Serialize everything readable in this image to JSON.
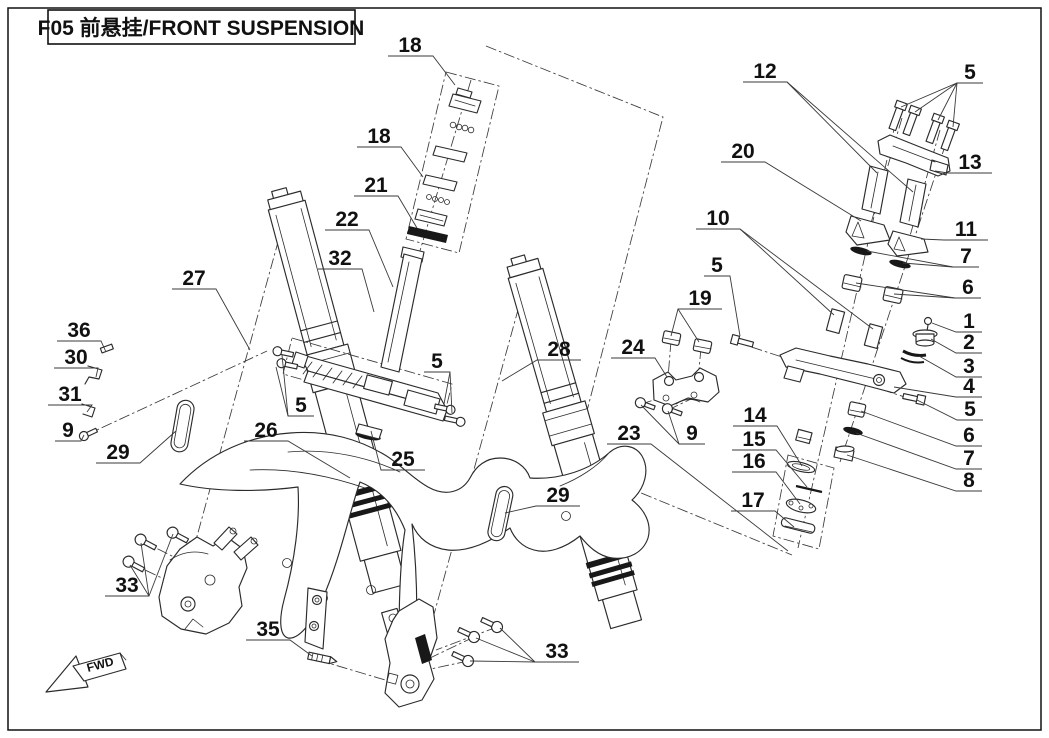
{
  "title": {
    "text": "F05 前悬挂/FRONT SUSPENSION"
  },
  "fwd_marker": "FWD",
  "diagram": {
    "type": "exploded-parts-diagram",
    "subject": "front suspension assembly",
    "part_numbers_shown": [
      "1",
      "2",
      "3",
      "4",
      "5",
      "6",
      "7",
      "8",
      "9",
      "10",
      "11",
      "12",
      "13",
      "14",
      "15",
      "16",
      "17",
      "18",
      "19",
      "20",
      "21",
      "22",
      "23",
      "24",
      "25",
      "26",
      "27",
      "28",
      "29",
      "30",
      "31",
      "32",
      "33",
      "35",
      "36"
    ]
  },
  "callouts": [
    {
      "n": "18",
      "t": [
        410,
        44
      ],
      "l": [
        [
          [
            388,
            56
          ],
          [
            433,
            56
          ],
          [
            455,
            85
          ]
        ]
      ]
    },
    {
      "n": "18",
      "t": [
        379,
        135
      ],
      "l": [
        [
          [
            357,
            147
          ],
          [
            401,
            147
          ],
          [
            423,
            177
          ]
        ]
      ]
    },
    {
      "n": "21",
      "t": [
        376,
        184
      ],
      "l": [
        [
          [
            354,
            196
          ],
          [
            398,
            196
          ],
          [
            417,
            228
          ]
        ]
      ]
    },
    {
      "n": "22",
      "t": [
        347,
        218
      ],
      "l": [
        [
          [
            325,
            230
          ],
          [
            369,
            230
          ],
          [
            393,
            287
          ]
        ]
      ]
    },
    {
      "n": "32",
      "t": [
        340,
        257
      ],
      "l": [
        [
          [
            318,
            269
          ],
          [
            362,
            269
          ],
          [
            374,
            312
          ]
        ]
      ]
    },
    {
      "n": "27",
      "t": [
        194,
        277
      ],
      "l": [
        [
          [
            172,
            289
          ],
          [
            216,
            289
          ],
          [
            250,
            350
          ]
        ]
      ]
    },
    {
      "n": "36",
      "t": [
        79,
        329
      ],
      "l": [
        [
          [
            57,
            341
          ],
          [
            101,
            341
          ],
          [
            106,
            352
          ]
        ]
      ]
    },
    {
      "n": "30",
      "t": [
        76,
        356
      ],
      "l": [
        [
          [
            54,
            368
          ],
          [
            98,
            368
          ],
          [
            96,
            377
          ]
        ]
      ]
    },
    {
      "n": "31",
      "t": [
        70,
        393
      ],
      "l": [
        [
          [
            48,
            405
          ],
          [
            92,
            405
          ],
          [
            87,
            412
          ]
        ]
      ]
    },
    {
      "n": "9",
      "t": [
        68,
        429
      ],
      "l": [
        [
          [
            55,
            441
          ],
          [
            81,
            441
          ],
          [
            84,
            435
          ]
        ]
      ]
    },
    {
      "n": "29",
      "t": [
        118,
        451
      ],
      "l": [
        [
          [
            96,
            463
          ],
          [
            140,
            463
          ],
          [
            176,
            431
          ]
        ]
      ]
    },
    {
      "n": "26",
      "t": [
        266,
        429
      ],
      "l": [
        [
          [
            244,
            441
          ],
          [
            288,
            441
          ],
          [
            350,
            478
          ]
        ]
      ]
    },
    {
      "n": "5",
      "t": [
        301,
        404
      ],
      "l": [
        [
          [
            314,
            416
          ],
          [
            288,
            416
          ],
          [
            276,
            367
          ]
        ],
        [
          [
            288,
            416
          ],
          [
            282,
            355
          ]
        ]
      ]
    },
    {
      "n": "25",
      "t": [
        403,
        458
      ],
      "l": [
        [
          [
            425,
            470
          ],
          [
            381,
            470
          ],
          [
            371,
            431
          ]
        ]
      ]
    },
    {
      "n": "28",
      "t": [
        559,
        348
      ],
      "l": [
        [
          [
            581,
            360
          ],
          [
            537,
            360
          ],
          [
            502,
            381
          ]
        ]
      ]
    },
    {
      "n": "29",
      "t": [
        558,
        494
      ],
      "l": [
        [
          [
            580,
            506
          ],
          [
            536,
            506
          ],
          [
            505,
            513
          ]
        ]
      ]
    },
    {
      "n": "33",
      "t": [
        127,
        584
      ],
      "l": [
        [
          [
            105,
            596
          ],
          [
            149,
            596
          ],
          [
            141,
            543
          ]
        ],
        [
          [
            149,
            596
          ],
          [
            173,
            534
          ]
        ],
        [
          [
            149,
            596
          ],
          [
            130,
            565
          ]
        ]
      ]
    },
    {
      "n": "35",
      "t": [
        268,
        628
      ],
      "l": [
        [
          [
            246,
            640
          ],
          [
            290,
            640
          ],
          [
            312,
            656
          ]
        ]
      ]
    },
    {
      "n": "33",
      "t": [
        557,
        650
      ],
      "l": [
        [
          [
            579,
            662
          ],
          [
            535,
            662
          ],
          [
            500,
            628
          ]
        ],
        [
          [
            535,
            662
          ],
          [
            476,
            638
          ]
        ],
        [
          [
            535,
            662
          ],
          [
            470,
            661
          ]
        ]
      ]
    },
    {
      "n": "12",
      "t": [
        765,
        70
      ],
      "l": [
        [
          [
            743,
            82
          ],
          [
            787,
            82
          ],
          [
            877,
            173
          ]
        ],
        [
          [
            787,
            82
          ],
          [
            913,
            192
          ]
        ]
      ]
    },
    {
      "n": "5",
      "t": [
        970,
        71
      ],
      "l": [
        [
          [
            983,
            83
          ],
          [
            957,
            83
          ],
          [
            901,
            107
          ]
        ],
        [
          [
            957,
            83
          ],
          [
            915,
            112
          ]
        ],
        [
          [
            957,
            83
          ],
          [
            938,
            120
          ]
        ],
        [
          [
            957,
            83
          ],
          [
            953,
            127
          ]
        ]
      ]
    },
    {
      "n": "20",
      "t": [
        743,
        150
      ],
      "l": [
        [
          [
            721,
            162
          ],
          [
            765,
            162
          ],
          [
            861,
            221
          ]
        ]
      ]
    },
    {
      "n": "13",
      "t": [
        970,
        161
      ],
      "l": [
        [
          [
            992,
            173
          ],
          [
            948,
            173
          ],
          [
            935,
            171
          ]
        ]
      ]
    },
    {
      "n": "10",
      "t": [
        718,
        217
      ],
      "l": [
        [
          [
            696,
            229
          ],
          [
            740,
            229
          ],
          [
            834,
            315
          ]
        ],
        [
          [
            740,
            229
          ],
          [
            873,
            329
          ]
        ]
      ]
    },
    {
      "n": "11",
      "t": [
        966,
        228
      ],
      "l": [
        [
          [
            988,
            240
          ],
          [
            944,
            240
          ],
          [
            921,
            239
          ]
        ]
      ]
    },
    {
      "n": "7",
      "t": [
        966,
        255
      ],
      "l": [
        [
          [
            979,
            267
          ],
          [
            953,
            267
          ],
          [
            867,
            251
          ]
        ],
        [
          [
            953,
            267
          ],
          [
            903,
            263
          ]
        ]
      ]
    },
    {
      "n": "6",
      "t": [
        968,
        286
      ],
      "l": [
        [
          [
            981,
            298
          ],
          [
            955,
            298
          ],
          [
            856,
            283
          ]
        ],
        [
          [
            955,
            298
          ],
          [
            894,
            294
          ]
        ]
      ]
    },
    {
      "n": "5",
      "t": [
        717,
        264
      ],
      "l": [
        [
          [
            704,
            276
          ],
          [
            730,
            276
          ],
          [
            740,
            336
          ]
        ]
      ]
    },
    {
      "n": "19",
      "t": [
        700,
        297
      ],
      "l": [
        [
          [
            722,
            309
          ],
          [
            678,
            309
          ],
          [
            671,
            336
          ]
        ],
        [
          [
            678,
            309
          ],
          [
            699,
            342
          ]
        ]
      ]
    },
    {
      "n": "1",
      "t": [
        969,
        320
      ],
      "l": [
        [
          [
            982,
            332
          ],
          [
            956,
            332
          ],
          [
            932,
            323
          ]
        ]
      ]
    },
    {
      "n": "2",
      "t": [
        969,
        341
      ],
      "l": [
        [
          [
            982,
            353
          ],
          [
            956,
            353
          ],
          [
            931,
            339
          ]
        ]
      ]
    },
    {
      "n": "3",
      "t": [
        969,
        365
      ],
      "l": [
        [
          [
            982,
            377
          ],
          [
            956,
            377
          ],
          [
            919,
            356
          ]
        ]
      ]
    },
    {
      "n": "4",
      "t": [
        969,
        385
      ],
      "l": [
        [
          [
            982,
            397
          ],
          [
            956,
            397
          ],
          [
            894,
            387
          ]
        ]
      ]
    },
    {
      "n": "5",
      "t": [
        970,
        408
      ],
      "l": [
        [
          [
            983,
            420
          ],
          [
            957,
            420
          ],
          [
            917,
            400
          ]
        ]
      ]
    },
    {
      "n": "6",
      "t": [
        969,
        434
      ],
      "l": [
        [
          [
            982,
            446
          ],
          [
            956,
            446
          ],
          [
            861,
            411
          ]
        ]
      ]
    },
    {
      "n": "7",
      "t": [
        969,
        457
      ],
      "l": [
        [
          [
            982,
            469
          ],
          [
            956,
            469
          ],
          [
            856,
            433
          ]
        ]
      ]
    },
    {
      "n": "8",
      "t": [
        969,
        479
      ],
      "l": [
        [
          [
            982,
            491
          ],
          [
            956,
            491
          ],
          [
            847,
            455
          ]
        ]
      ]
    },
    {
      "n": "24",
      "t": [
        633,
        346
      ],
      "l": [
        [
          [
            611,
            358
          ],
          [
            655,
            358
          ],
          [
            667,
            377
          ]
        ]
      ]
    },
    {
      "n": "23",
      "t": [
        629,
        432
      ],
      "l": [
        [
          [
            607,
            444
          ],
          [
            651,
            444
          ],
          [
            788,
            551
          ]
        ]
      ]
    },
    {
      "n": "9",
      "t": [
        692,
        432
      ],
      "l": [
        [
          [
            705,
            444
          ],
          [
            679,
            444
          ],
          [
            641,
            405
          ]
        ],
        [
          [
            679,
            444
          ],
          [
            668,
            411
          ]
        ]
      ]
    },
    {
      "n": "14",
      "t": [
        755,
        414
      ],
      "l": [
        [
          [
            733,
            426
          ],
          [
            777,
            426
          ],
          [
            802,
            466
          ]
        ]
      ]
    },
    {
      "n": "15",
      "t": [
        754,
        438
      ],
      "l": [
        [
          [
            732,
            450
          ],
          [
            776,
            450
          ],
          [
            807,
            487
          ]
        ]
      ]
    },
    {
      "n": "16",
      "t": [
        754,
        460
      ],
      "l": [
        [
          [
            732,
            472
          ],
          [
            776,
            472
          ],
          [
            800,
            504
          ]
        ]
      ]
    },
    {
      "n": "17",
      "t": [
        753,
        499
      ],
      "l": [
        [
          [
            731,
            511
          ],
          [
            775,
            511
          ],
          [
            794,
            527
          ]
        ]
      ]
    },
    {
      "n": "5",
      "t": [
        437,
        360
      ],
      "l": [
        [
          [
            424,
            372
          ],
          [
            450,
            372
          ],
          [
            444,
            404
          ]
        ],
        [
          [
            450,
            372
          ],
          [
            452,
            413
          ]
        ]
      ]
    }
  ]
}
